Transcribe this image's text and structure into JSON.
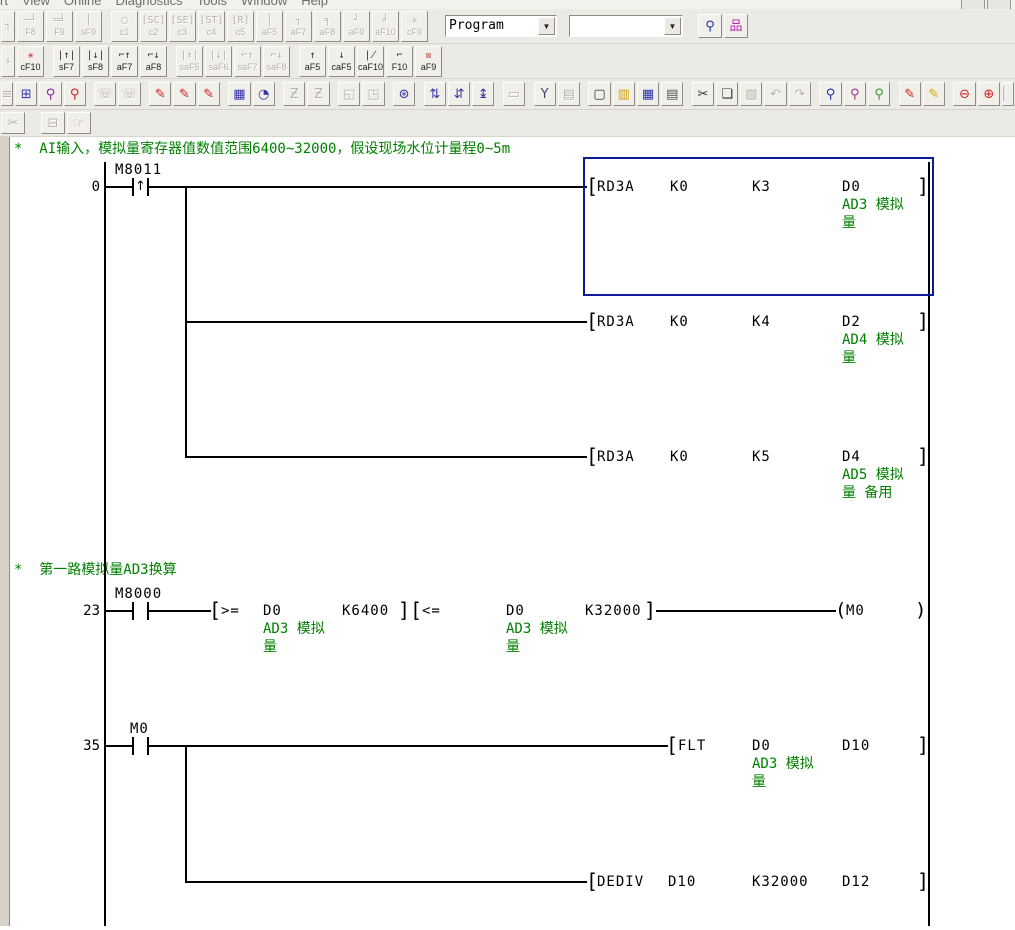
{
  "window": {
    "app": "GX Developer ladder editor"
  },
  "colors": {
    "selection_blue": "#0c1a97",
    "comment_green": "#008000",
    "wire_black": "#000000",
    "toolbar_bg": "#eceae4"
  },
  "menu": {
    "items": [
      {
        "name": "menu-convert-partial",
        "label": "rt"
      },
      {
        "name": "menu-view",
        "label": "View"
      },
      {
        "name": "menu-online",
        "label": "Online"
      },
      {
        "name": "menu-diagnostics",
        "label": "Diagnostics"
      },
      {
        "name": "menu-tools",
        "label": "Tools"
      },
      {
        "name": "menu-window",
        "label": "Window"
      },
      {
        "name": "menu-help",
        "label": "Help"
      }
    ]
  },
  "toolbar1": {
    "combo_program": "Program",
    "combo_second": "",
    "buttons": [
      {
        "name": "ladder-symbol-partial",
        "glyph": "┐",
        "label": "",
        "state": "disabled partial"
      },
      {
        "name": "ladder-symbol-f8",
        "glyph": "─┘",
        "label": "F8",
        "state": "disabled"
      },
      {
        "name": "ladder-symbol-f9",
        "glyph": "═╛",
        "label": "F9",
        "state": "disabled"
      },
      {
        "name": "ladder-symbol-sf9",
        "glyph": "│",
        "label": "sF9",
        "state": "disabled"
      },
      {
        "sep": true
      },
      {
        "name": "ladder-symbol-c1",
        "glyph": "▢",
        "label": "c1",
        "state": "disabled"
      },
      {
        "name": "ladder-symbol-c2",
        "glyph": "[SC]",
        "label": "c2",
        "state": "disabled"
      },
      {
        "name": "ladder-symbol-c3",
        "glyph": "[SE]",
        "label": "c3",
        "state": "disabled"
      },
      {
        "name": "ladder-symbol-c4",
        "glyph": "[ST]",
        "label": "c4",
        "state": "disabled"
      },
      {
        "name": "ladder-symbol-c5",
        "glyph": "[R]",
        "label": "c5",
        "state": "disabled"
      },
      {
        "name": "ladder-symbol-af5",
        "glyph": "│",
        "label": "aF5",
        "state": "disabled"
      },
      {
        "name": "ladder-symbol-af7",
        "glyph": "┐",
        "label": "aF7",
        "state": "disabled"
      },
      {
        "name": "ladder-symbol-af8",
        "glyph": "╕",
        "label": "aF8",
        "state": "disabled"
      },
      {
        "name": "ladder-symbol-af9",
        "glyph": "┘",
        "label": "aF9",
        "state": "disabled"
      },
      {
        "name": "ladder-symbol-af10",
        "glyph": "╛",
        "label": "aF10",
        "state": "disabled"
      },
      {
        "name": "ladder-symbol-cf9",
        "glyph": "✳",
        "label": "cF9",
        "state": "disabled"
      }
    ],
    "combo_buttons": [
      {
        "name": "find-in-program-button",
        "glyph": "⚲",
        "color": "#2233aa",
        "state": "enabled"
      },
      {
        "name": "project-tree-toggle-button",
        "glyph": "品",
        "color": "#bb22bb",
        "state": "enabled"
      }
    ]
  },
  "toolbar2": {
    "buttons": [
      {
        "name": "pulse-symbol-partial",
        "glyph": "↓",
        "label": "",
        "state": "disabled partial"
      },
      {
        "name": "delete-symbol-cf10",
        "glyph": "✳",
        "label": "cF10",
        "state": "red"
      },
      {
        "sep": true
      },
      {
        "name": "rising-pulse-contact-sf7",
        "glyph": "|↑|",
        "label": "sF7",
        "state": "enabled"
      },
      {
        "name": "falling-pulse-contact-sf8",
        "glyph": "|↓|",
        "label": "sF8",
        "state": "enabled"
      },
      {
        "name": "rising-pulse-branch-af7",
        "glyph": "⌐↑",
        "label": "aF7",
        "state": "enabled"
      },
      {
        "name": "falling-pulse-branch-af8",
        "glyph": "⌐↓",
        "label": "aF8",
        "state": "enabled"
      },
      {
        "sep": true
      },
      {
        "name": "rising-pulse-close-saf5",
        "glyph": "|↑|",
        "label": "saF5",
        "state": "disabled"
      },
      {
        "name": "falling-pulse-close-saf6",
        "glyph": "|↓|",
        "label": "saF6",
        "state": "disabled"
      },
      {
        "name": "rising-pulse-close-branch-saf7",
        "glyph": "⌐↑",
        "label": "saF7",
        "state": "disabled"
      },
      {
        "name": "falling-pulse-close-branch-saf8",
        "glyph": "⌐↓",
        "label": "saF8",
        "state": "disabled"
      },
      {
        "sep": true
      },
      {
        "name": "insert-row-af5",
        "glyph": "↑",
        "label": "aF5",
        "state": "enabled"
      },
      {
        "name": "delete-row-caf5",
        "glyph": "↓",
        "label": "caF5",
        "state": "enabled"
      },
      {
        "name": "delete-line-caf10",
        "glyph": "∤",
        "label": "caF10",
        "state": "enabled"
      },
      {
        "name": "draw-line-f10",
        "glyph": "⌐",
        "label": "F10",
        "state": "enabled"
      },
      {
        "name": "delete-line-af9",
        "glyph": "☒",
        "label": "aF9",
        "state": "red"
      }
    ]
  },
  "toolbar3": {
    "icons": [
      {
        "name": "toolbar-partial-left-icon",
        "glyph": "≡",
        "state": "disabled partial"
      },
      {
        "name": "ladder-edit-mode-icon",
        "glyph": "⊞",
        "color": "#3333aa",
        "state": "enabled"
      },
      {
        "name": "device-find-icon",
        "glyph": "⚲",
        "color": "#882299",
        "state": "enabled"
      },
      {
        "name": "device-test-icon",
        "glyph": "⚲",
        "color": "#cc2222",
        "state": "enabled"
      },
      {
        "sep": true
      },
      {
        "name": "contact-list-icon",
        "glyph": "☏",
        "state": "disabled"
      },
      {
        "name": "device-use-list-icon",
        "glyph": "☏",
        "state": "disabled"
      },
      {
        "sep": true
      },
      {
        "name": "device-entry-write-icon",
        "glyph": "✎",
        "color": "#cc2222",
        "state": "enabled"
      },
      {
        "name": "ladder-write-icon",
        "glyph": "✎",
        "color": "#cc2222",
        "state": "enabled"
      },
      {
        "name": "change-value-icon",
        "glyph": "✎",
        "color": "#cc2222",
        "state": "enabled"
      },
      {
        "sep": true
      },
      {
        "name": "device-batch-monitor-icon",
        "glyph": "▦",
        "color": "#3333aa",
        "state": "enabled"
      },
      {
        "name": "sampling-trace-icon",
        "glyph": "◔",
        "color": "#3333aa",
        "state": "enabled"
      },
      {
        "sep": true
      },
      {
        "name": "step-run-icon",
        "glyph": "Ƶ",
        "state": "disabled"
      },
      {
        "name": "partial-run-icon",
        "glyph": "Ƶ",
        "state": "disabled"
      },
      {
        "sep": true
      },
      {
        "name": "window-restore-icon",
        "glyph": "◱",
        "state": "disabled"
      },
      {
        "name": "window-new-icon",
        "glyph": "◳",
        "state": "disabled"
      },
      {
        "sep": true
      },
      {
        "name": "network-monitor-icon",
        "glyph": "⊛",
        "color": "#3333aa",
        "state": "enabled"
      },
      {
        "sep": true
      },
      {
        "name": "scan-time-up-icon",
        "glyph": "⇅",
        "color": "#3333aa",
        "state": "enabled"
      },
      {
        "name": "scan-time-down-icon",
        "glyph": "⇵",
        "color": "#3333aa",
        "state": "enabled"
      },
      {
        "name": "scan-time-auto-icon",
        "glyph": "↨",
        "color": "#3333aa",
        "state": "enabled"
      },
      {
        "sep": true
      },
      {
        "name": "monitor-screen-icon",
        "glyph": "▭",
        "state": "disabled"
      },
      {
        "sep": true
      },
      {
        "name": "project-data-list-icon",
        "glyph": "Y",
        "color": "#444477",
        "state": "enabled"
      },
      {
        "name": "ladder-view-icon",
        "glyph": "▤",
        "state": "disabled"
      },
      {
        "sep": true
      },
      {
        "name": "new-file-icon",
        "glyph": "▢",
        "color": "#333333",
        "state": "enabled"
      },
      {
        "name": "open-file-icon",
        "glyph": "▥",
        "color": "#d4a017",
        "state": "enabled"
      },
      {
        "name": "save-file-icon",
        "glyph": "▦",
        "color": "#2233aa",
        "state": "enabled"
      },
      {
        "name": "print-icon",
        "glyph": "▤",
        "color": "#555555",
        "state": "enabled"
      },
      {
        "sep": true
      },
      {
        "name": "cut-icon",
        "glyph": "✂",
        "color": "#333333",
        "state": "enabled"
      },
      {
        "name": "copy-icon",
        "glyph": "❏",
        "color": "#333333",
        "state": "enabled"
      },
      {
        "name": "paste-icon",
        "glyph": "▧",
        "state": "disabled"
      },
      {
        "name": "undo-icon",
        "glyph": "↶",
        "state": "disabled"
      },
      {
        "name": "redo-icon",
        "glyph": "↷",
        "state": "disabled"
      },
      {
        "sep": true
      },
      {
        "name": "find-icon",
        "glyph": "⚲",
        "color": "#2233aa",
        "state": "enabled"
      },
      {
        "name": "find-replace-icon",
        "glyph": "⚲",
        "color": "#993399",
        "state": "enabled"
      },
      {
        "name": "find-string-icon",
        "glyph": "⚲",
        "color": "#339933",
        "state": "enabled"
      },
      {
        "sep": true
      },
      {
        "name": "comment-write-icon",
        "glyph": "✎",
        "color": "#cc2222",
        "state": "enabled"
      },
      {
        "name": "statement-write-icon",
        "glyph": "✎",
        "color": "#ccaa00",
        "state": "enabled"
      },
      {
        "sep": true
      },
      {
        "name": "zoom-out-icon",
        "glyph": "⊖",
        "color": "#cc2222",
        "state": "enabled"
      },
      {
        "name": "zoom-in-icon",
        "glyph": "⊕",
        "color": "#cc2222",
        "state": "enabled"
      },
      {
        "name": "toolbar-partial-right-icon",
        "glyph": "▏",
        "state": "disabled partial"
      }
    ]
  },
  "toolbar4": {
    "icons": [
      {
        "name": "row4-partial-icon",
        "glyph": "✂",
        "state": "disabled partial"
      },
      {
        "sep": true
      },
      {
        "sep": true
      },
      {
        "name": "print-preview-icon",
        "glyph": "⊟",
        "state": "disabled"
      },
      {
        "name": "pan-hand-icon",
        "glyph": "☞",
        "state": "disabled"
      }
    ]
  },
  "ladder": {
    "comment_ai": "*  AI输入，模拟量寄存器值数值范围6400~32000，假设现场水位计量程0~5m",
    "comment_ad3": "*  第一路模拟量AD3换算",
    "rung0": {
      "step": "0",
      "contact_label": "M8011",
      "inst1": {
        "op": "RD3A",
        "a": "K0",
        "b": "K3",
        "c": "D0",
        "cmt1": "AD3 模拟",
        "cmt2": "量"
      },
      "inst2": {
        "op": "RD3A",
        "a": "K0",
        "b": "K4",
        "c": "D2",
        "cmt1": "AD4 模拟",
        "cmt2": "量"
      },
      "inst3": {
        "op": "RD3A",
        "a": "K0",
        "b": "K5",
        "c": "D4",
        "cmt1": "AD5 模拟",
        "cmt2": "量 备用"
      }
    },
    "rung23": {
      "step": "23",
      "contact_label": "M8000",
      "cmp1": {
        "op": ">=",
        "a": "D0",
        "b": "K6400",
        "cmt1": "AD3 模拟",
        "cmt2": "量"
      },
      "cmp2": {
        "op": "<=",
        "a": "D0",
        "b": "K32000",
        "cmt1": "AD3 模拟",
        "cmt2": "量"
      },
      "coil": {
        "device": "M0"
      }
    },
    "rung35": {
      "step": "35",
      "contact_label": "M0",
      "inst1": {
        "op": "FLT",
        "a": "D0",
        "b": "D10",
        "cmt1": "AD3 模拟",
        "cmt2": "量"
      },
      "inst2": {
        "op": "DEDIV",
        "a": "D10",
        "b": "K32000",
        "c": "D12"
      }
    }
  }
}
